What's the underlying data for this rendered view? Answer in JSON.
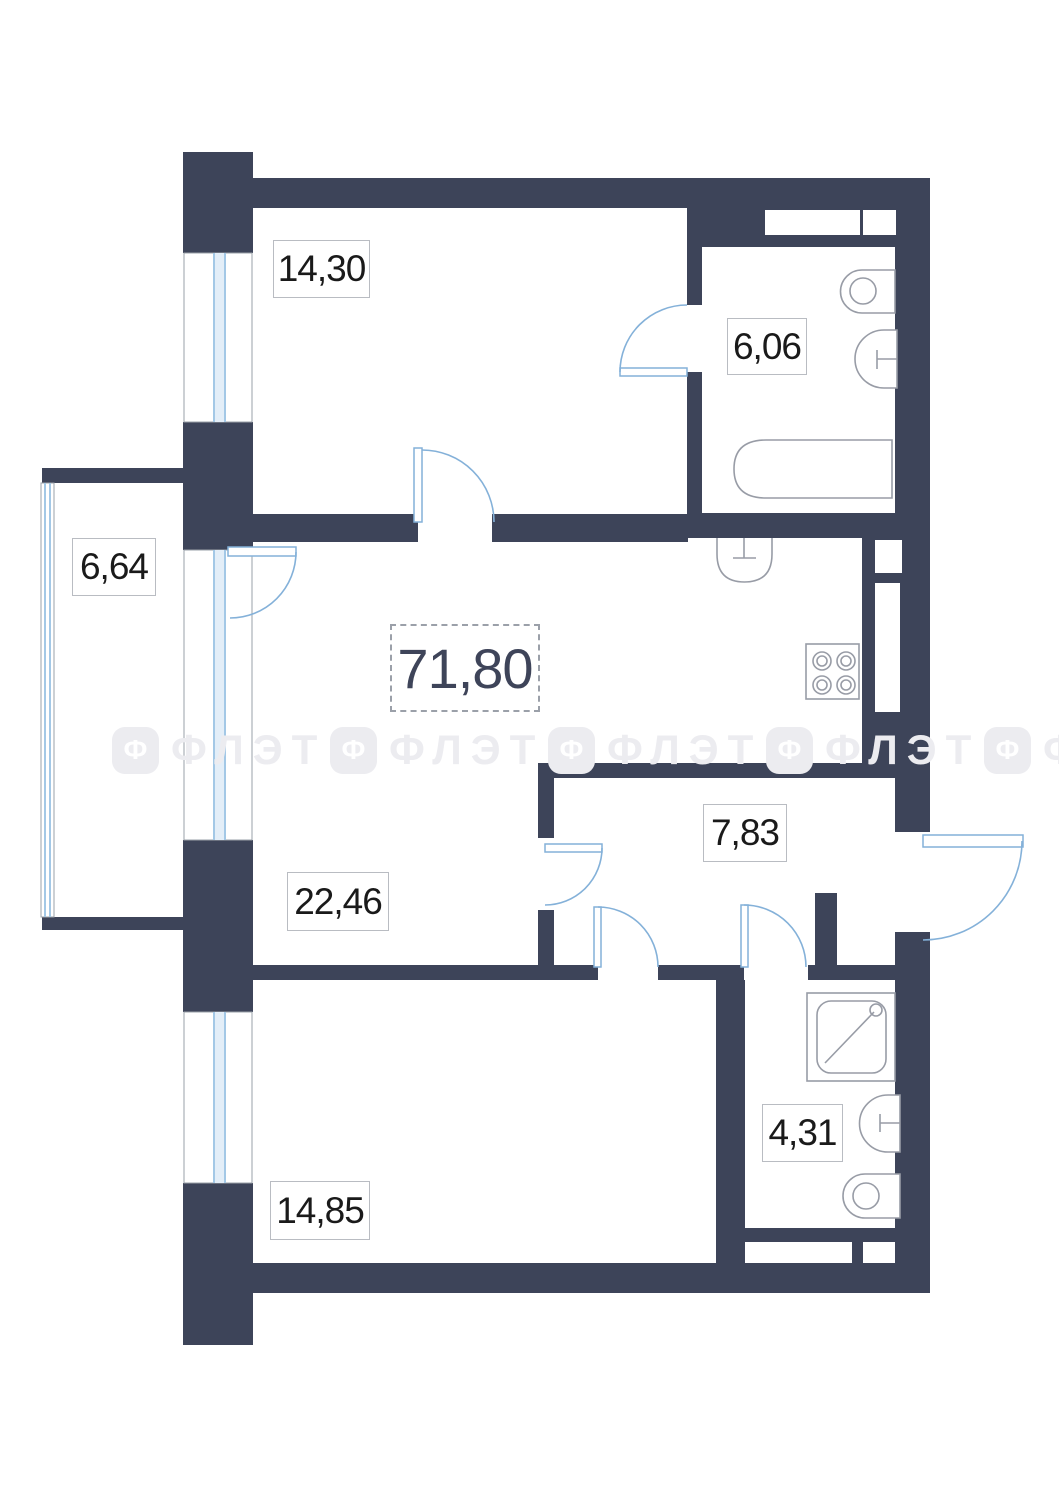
{
  "total": {
    "area": "71,80"
  },
  "rooms": {
    "room1": {
      "area": "14,30"
    },
    "bath1": {
      "area": "6,06"
    },
    "balcony": {
      "area": "6,64"
    },
    "living": {
      "area": "22,46"
    },
    "hall": {
      "area": "7,83"
    },
    "room2": {
      "area": "14,85"
    },
    "bath2": {
      "area": "4,31"
    }
  },
  "watermark": {
    "icon_letter": "Ф",
    "text": "ФЛЭТ"
  },
  "colors": {
    "bg": "#ffffff",
    "wall": "#3d4459",
    "glass": "#a3c8e6",
    "glassFill": "#e3eef8",
    "frame": "#9aa0a8",
    "door": "#84b1d9",
    "fixture": "#989ca6",
    "labelBorder": "#b9bcc2",
    "labelText": "#1a1a1a",
    "totalText": "#3e4459",
    "dashBorder": "#9ba0a9",
    "watermark": "#ececf0"
  }
}
